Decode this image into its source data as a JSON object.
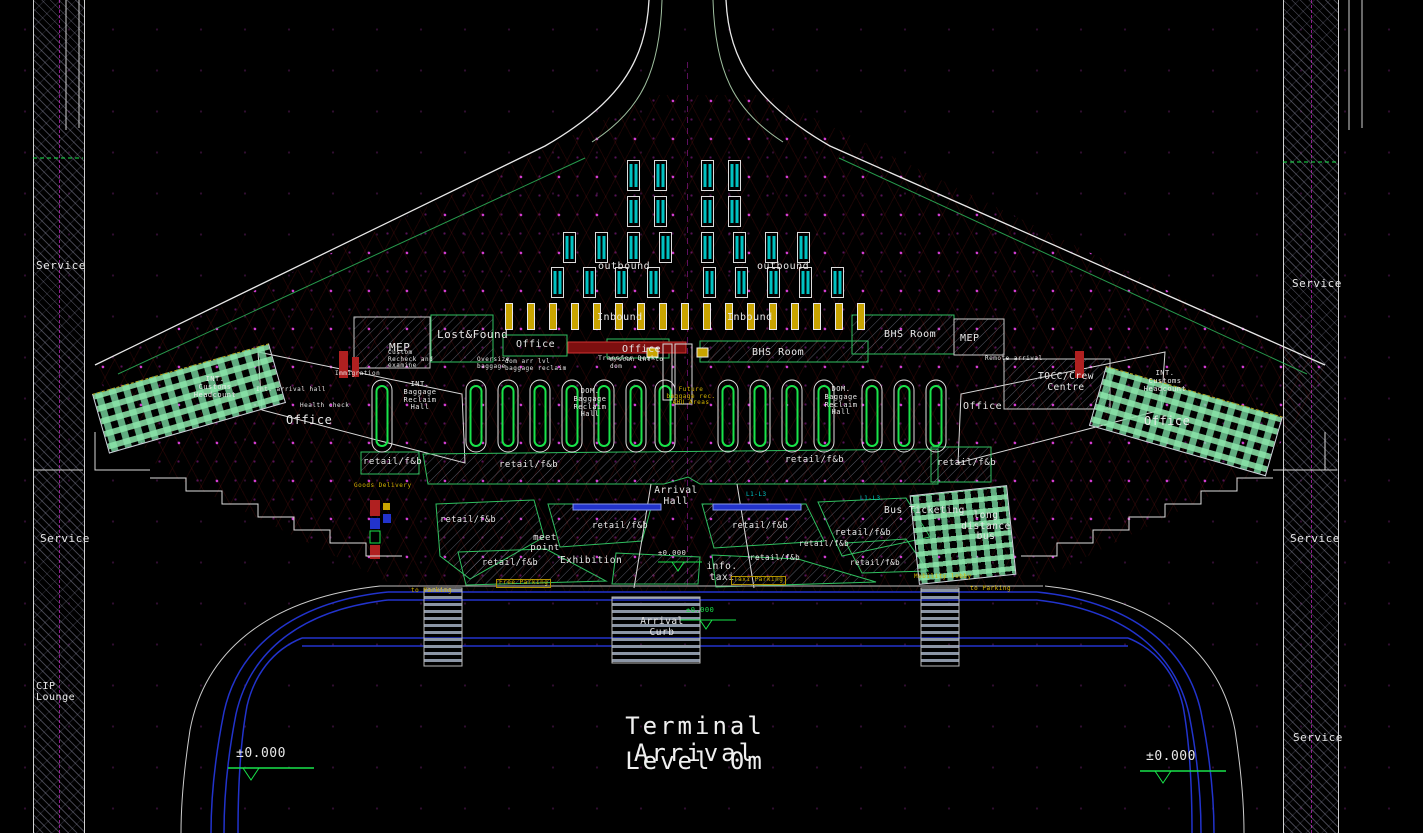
{
  "title": {
    "line1": "Terminal  Arrival",
    "line2": "Level   0m"
  },
  "labels": {
    "service": "Service",
    "cip_lounge": "CIP\nLounge",
    "outbound": "outbound",
    "inbound": "Inbound",
    "mep": "MEP",
    "lost_found": "Lost&Found",
    "office": "Office",
    "transfer_desk": "Transfer Desk",
    "bhs_room": "BHS Room",
    "remote_arrival": "Remote arrival",
    "tocc": "TOCC/Crew\nCentre",
    "int_customs": "INT.\nCustoms\nHeadcount",
    "health_check": "Health check",
    "immigration": "Immigration",
    "int_arrival_hall": "Int. arrival hall",
    "int_baggage": "INT.\nBaggage\nReclaim\nHall",
    "dom_baggage": "DOM.\nBaggage\nReclaim\nHall",
    "future_ahu": "Future\nbaggage rec.\nAHU Areas",
    "custom_recheck": "Custom\nRecheck and\nexamine",
    "oversize_baggage": "Oversize\nbaggage",
    "dom_arr_reclaim": "dom arr lvl\nbaggage reclaim",
    "mscan": "m/scan int to\ndom",
    "retail_fb": "retail/f&b",
    "goods_delivery": "Goods Delivery",
    "arrival_hall": "Arrival\nHall",
    "meet_point": "meet\npoint",
    "exhibition": "Exhibition",
    "info_taxi": "info.\ntaxi",
    "bus_ticketing": "Bus Ticketing",
    "long_distance_bus": "long distance\nbus",
    "arrival_curb": "Arrival\nCurb",
    "to_parking": "to Parking",
    "free_parking": "Free Parking",
    "taxi_parking": "Taxi Parking",
    "mobility_lobby": "Mobility lobby",
    "l1_l3": "L1-L3"
  },
  "elevations": {
    "zero": "±0.000",
    "zero_short": "±0.00"
  },
  "colors": {
    "background": "#000000",
    "line_white": "#e8e8e8",
    "line_green": "#19e34a",
    "grid_magenta": "#cc22cc",
    "escalator_cyan": "#00c2c2",
    "belt_yellow": "#c9a400",
    "road_blue": "#2233cc",
    "alert_red": "#b02020",
    "counter_mint": "#8ce6aa"
  }
}
